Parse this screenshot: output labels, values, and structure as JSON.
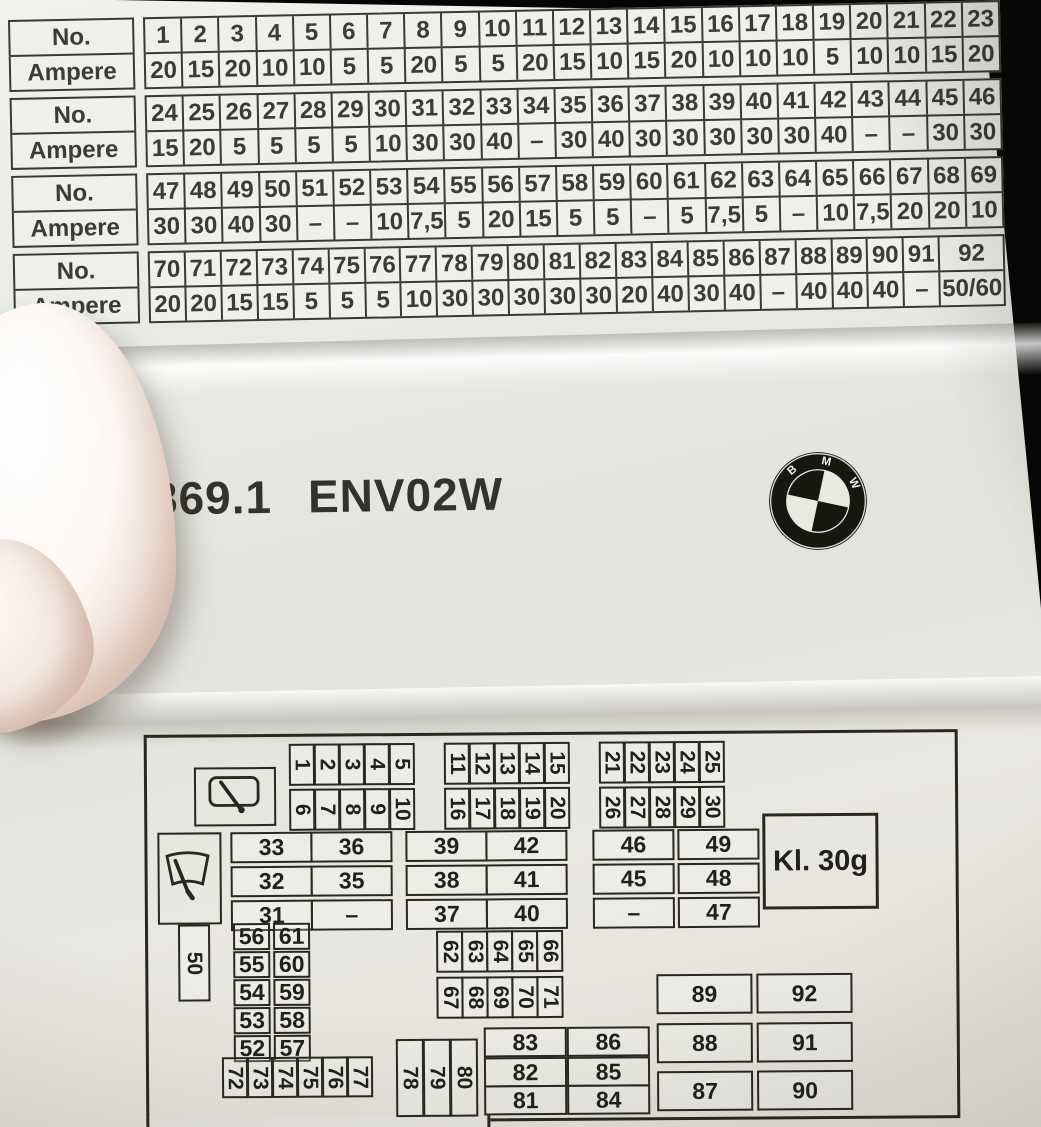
{
  "fuse_tables": {
    "no_label": "No.",
    "ampere_label": "Ampere",
    "tables": [
      {
        "numbers": [
          "1",
          "2",
          "3",
          "4",
          "5",
          "6",
          "7",
          "8",
          "9",
          "10",
          "11",
          "12",
          "13",
          "14",
          "15",
          "16",
          "17",
          "18",
          "19",
          "20",
          "21",
          "22",
          "23"
        ],
        "amperes": [
          "20",
          "15",
          "20",
          "10",
          "10",
          "5",
          "5",
          "20",
          "5",
          "5",
          "20",
          "15",
          "10",
          "15",
          "20",
          "10",
          "10",
          "10",
          "5",
          "10",
          "10",
          "15",
          "20"
        ],
        "wide_last": false
      },
      {
        "numbers": [
          "24",
          "25",
          "26",
          "27",
          "28",
          "29",
          "30",
          "31",
          "32",
          "33",
          "34",
          "35",
          "36",
          "37",
          "38",
          "39",
          "40",
          "41",
          "42",
          "43",
          "44",
          "45",
          "46"
        ],
        "amperes": [
          "15",
          "20",
          "5",
          "5",
          "5",
          "5",
          "10",
          "30",
          "30",
          "40",
          "–",
          "30",
          "40",
          "30",
          "30",
          "30",
          "30",
          "30",
          "40",
          "–",
          "–",
          "30",
          "30"
        ],
        "wide_last": false
      },
      {
        "numbers": [
          "47",
          "48",
          "49",
          "50",
          "51",
          "52",
          "53",
          "54",
          "55",
          "56",
          "57",
          "58",
          "59",
          "60",
          "61",
          "62",
          "63",
          "64",
          "65",
          "66",
          "67",
          "68",
          "69"
        ],
        "amperes": [
          "30",
          "30",
          "40",
          "30",
          "–",
          "–",
          "10",
          "7,5",
          "5",
          "20",
          "15",
          "5",
          "5",
          "–",
          "5",
          "7,5",
          "5",
          "–",
          "10",
          "7,5",
          "20",
          "20",
          "10"
        ],
        "wide_last": false
      },
      {
        "numbers": [
          "70",
          "71",
          "72",
          "73",
          "74",
          "75",
          "76",
          "77",
          "78",
          "79",
          "80",
          "81",
          "82",
          "83",
          "84",
          "85",
          "86",
          "87",
          "88",
          "89",
          "90",
          "91",
          "92"
        ],
        "amperes": [
          "20",
          "20",
          "15",
          "15",
          "5",
          "5",
          "5",
          "10",
          "30",
          "30",
          "30",
          "30",
          "30",
          "20",
          "40",
          "30",
          "40",
          "–",
          "40",
          "40",
          "40",
          "–",
          "50/60"
        ],
        "wide_last": true
      }
    ]
  },
  "label_panel": {
    "part_number": "9 177 869.1",
    "variant_code": "ENV02W",
    "logo_letters": [
      "B",
      "M",
      "W"
    ]
  },
  "diagram": {
    "kl30g": "Kl. 30g",
    "fuse_50": "50",
    "top_groups": [
      {
        "row1": [
          "1",
          "2",
          "3",
          "4",
          "5"
        ],
        "row2": [
          "6",
          "7",
          "8",
          "9",
          "10"
        ]
      },
      {
        "row1": [
          "11",
          "12",
          "13",
          "14",
          "15"
        ],
        "row2": [
          "16",
          "17",
          "18",
          "19",
          "20"
        ]
      },
      {
        "row1": [
          "21",
          "22",
          "23",
          "24",
          "25"
        ],
        "row2": [
          "26",
          "27",
          "28",
          "29",
          "30"
        ]
      }
    ],
    "mid_columns": [
      [
        "33",
        "32",
        "31"
      ],
      [
        "36",
        "35",
        "–"
      ],
      [
        "39",
        "38",
        "37"
      ],
      [
        "42",
        "41",
        "40"
      ],
      [
        "46",
        "45",
        "–"
      ],
      [
        "49",
        "48",
        "47"
      ]
    ],
    "pair_columns": [
      [
        "56",
        "55",
        "54",
        "53",
        "52"
      ],
      [
        "61",
        "60",
        "59",
        "58",
        "57"
      ]
    ],
    "center_rows": [
      [
        "62",
        "63",
        "64",
        "65",
        "66"
      ],
      [
        "67",
        "68",
        "69",
        "70",
        "71"
      ]
    ],
    "bottom_small": [
      "72",
      "73",
      "74",
      "75",
      "76",
      "77"
    ],
    "bottom_tall": [
      "78",
      "79",
      "80"
    ],
    "bottom_columns": [
      [
        "83",
        "82",
        "81"
      ],
      [
        "86",
        "85",
        "84"
      ]
    ],
    "right_columns": [
      [
        "89",
        "88",
        "87"
      ],
      [
        "92",
        "91",
        "90"
      ]
    ]
  },
  "colors": {
    "paper": "#e8eae4",
    "ink": "#2b2b24",
    "background": "#000000"
  }
}
